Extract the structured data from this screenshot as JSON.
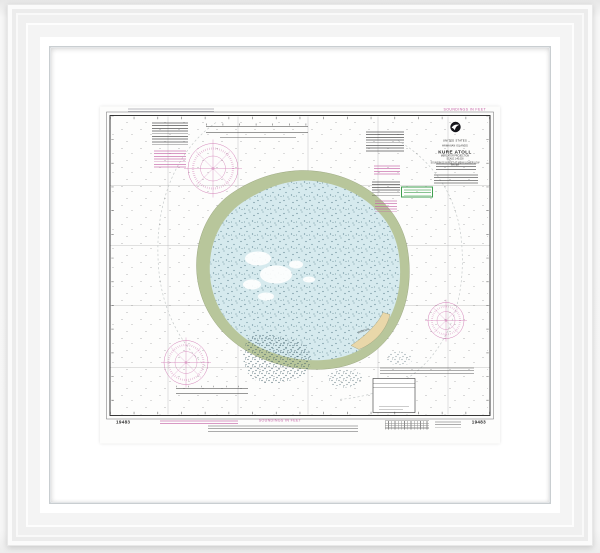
{
  "chart": {
    "top_margin": {
      "soundings_note": "SOUNDINGS IN FEET"
    },
    "bottom_margin": {
      "soundings_note": "SOUNDINGS IN FEET",
      "chart_number_left": "19483",
      "chart_number_right": "19483"
    },
    "title_block": {
      "agency": "UNITED STATES",
      "region": "HAWAIIAN ISLANDS",
      "title": "KURE ATOLL",
      "projection": "MERCATOR PROJECTION",
      "scale": "SCALE 1:40,000",
      "datum": "SOUNDINGS IN FEET AT MEAN LOWER LOW WATER"
    },
    "labels": {
      "island": "GREEN IS"
    },
    "icons": {
      "noaa_logo": "noaa-logo"
    },
    "colors": {
      "magenta": "#c25ba2",
      "lagoon": "#d6eaee",
      "reef": "#b8c69b",
      "island_sand": "#e9d7a9",
      "ink": "#2b2b2b"
    }
  }
}
